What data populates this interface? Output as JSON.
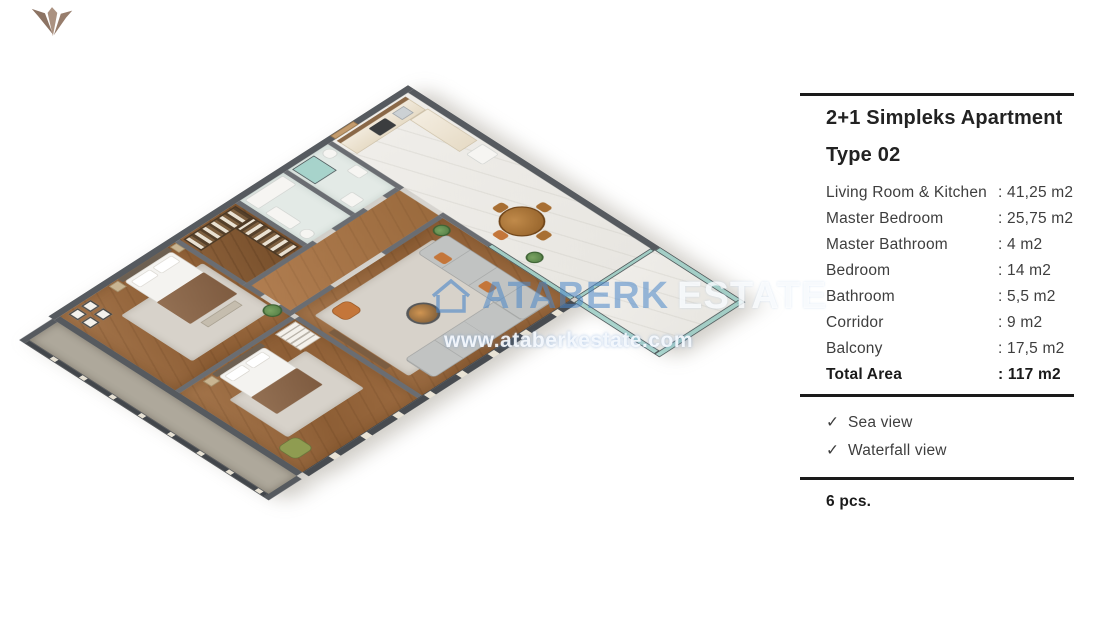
{
  "page": {
    "background": "#ffffff"
  },
  "logo": {
    "name": "ataberk-logo-mark",
    "color": "#9a8272"
  },
  "watermark": {
    "brand_primary": "ATABERK",
    "brand_secondary": "ESTATE",
    "url": "www.ataberkestate.com",
    "accent_blue": "#4d87c7"
  },
  "floor_plan_palette": {
    "wall_dark": "#565a5f",
    "wall_inner": "#6a6d72",
    "wood_floor": "#96663c",
    "marble_floor": "#edebe6",
    "glass_teal": "#97cdc4",
    "sofa_gray": "#c1c3c2",
    "accent_orange": "#c4763a",
    "accent_green": "#8f9c51"
  },
  "panel": {
    "title": "2+1 Simpleks Apartment",
    "subtitle": "Type 02",
    "rows": [
      {
        "label": "Living Room & Kitchen",
        "value": ": 41,25 m2"
      },
      {
        "label": "Master Bedroom",
        "value": ": 25,75 m2"
      },
      {
        "label": "Master Bathroom",
        "value": ": 4 m2"
      },
      {
        "label": "Bedroom",
        "value": ": 14 m2"
      },
      {
        "label": "Bathroom",
        "value": ": 5,5 m2"
      },
      {
        "label": "Corridor",
        "value": ": 9 m2"
      },
      {
        "label": "Balcony",
        "value": ": 17,5 m2"
      }
    ],
    "total": {
      "label": "Total Area",
      "value": ": 117 m2"
    },
    "features": [
      {
        "check": "✓",
        "label": "Sea view"
      },
      {
        "check": "✓",
        "label": "Waterfall view"
      }
    ],
    "count": "6 pcs."
  }
}
